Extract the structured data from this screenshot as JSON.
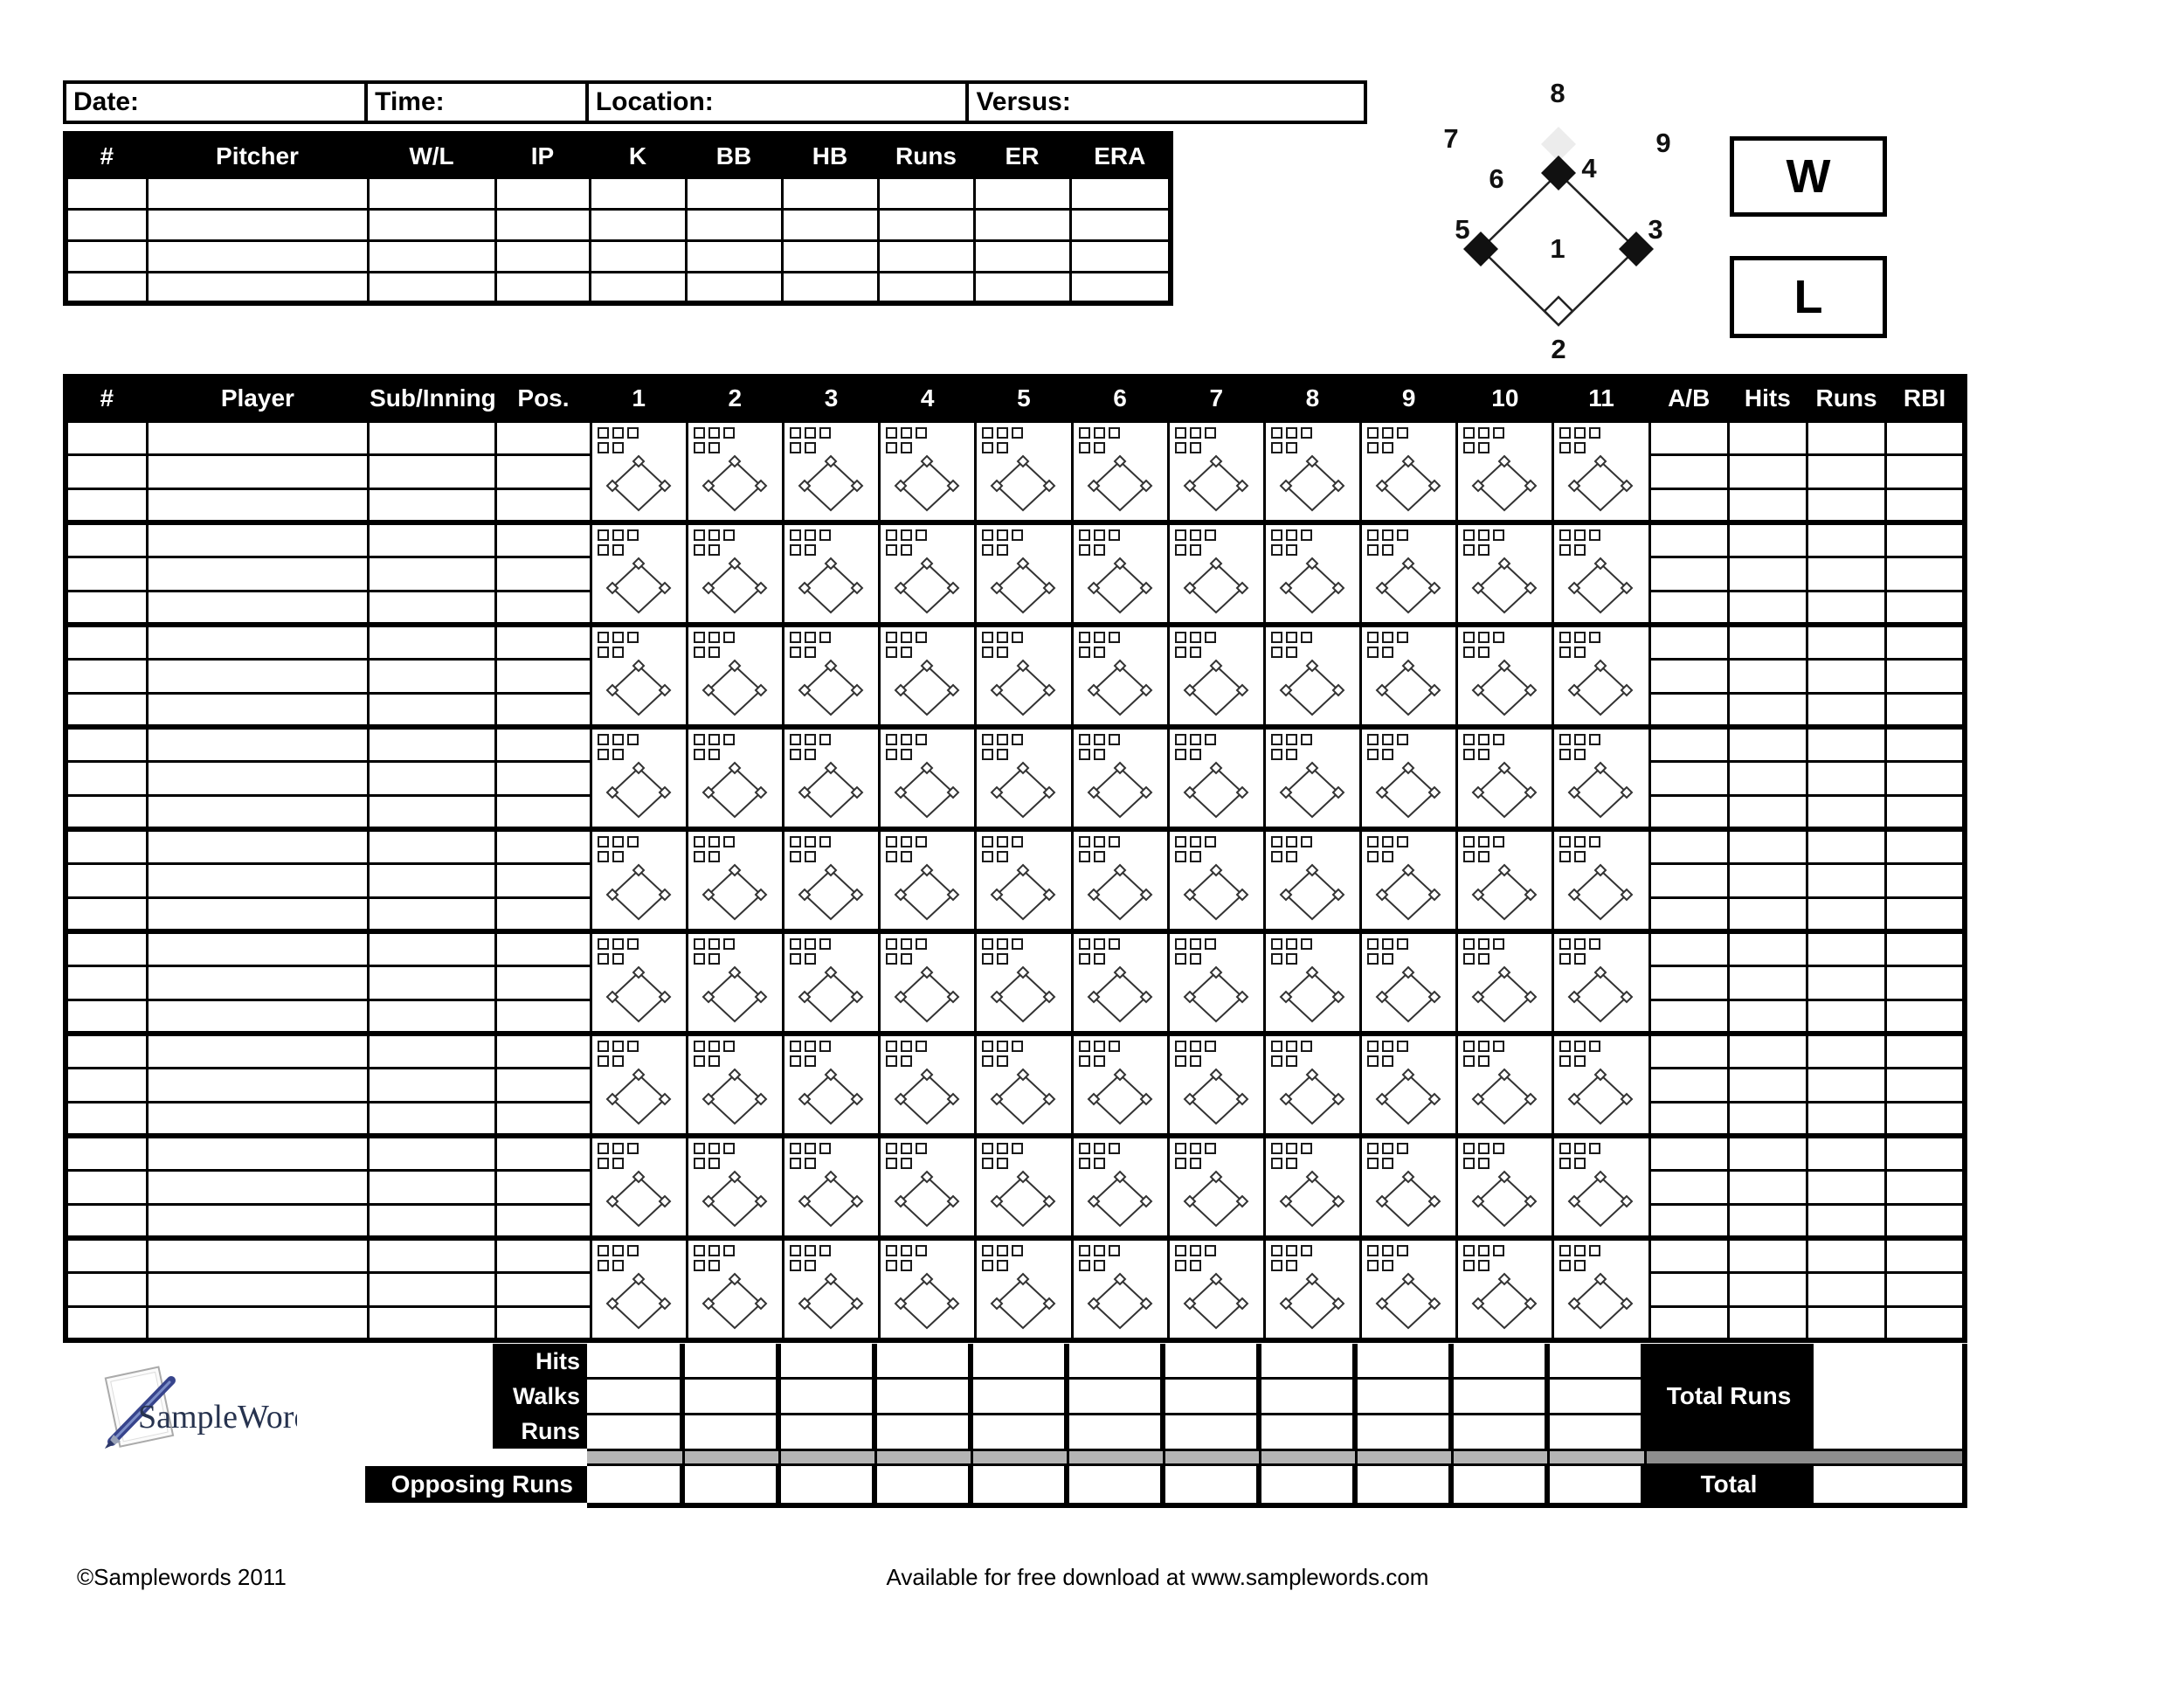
{
  "page": {
    "info_fields": [
      {
        "label": "Date:"
      },
      {
        "label": "Time:"
      },
      {
        "label": "Location:"
      },
      {
        "label": "Versus:"
      }
    ],
    "pitcher_table": {
      "headers": [
        "#",
        "Pitcher",
        "W/L",
        "IP",
        "K",
        "BB",
        "HB",
        "Runs",
        "ER",
        "ERA"
      ],
      "empty_rows": 4
    },
    "field_diagram": {
      "position_numbers": [
        "1",
        "2",
        "3",
        "4",
        "5",
        "6",
        "7",
        "8",
        "9"
      ]
    },
    "result_boxes": {
      "win": "W",
      "loss": "L"
    },
    "scorecard": {
      "left_headers": [
        "#",
        "Player",
        "Sub/Inning",
        "Pos."
      ],
      "inning_headers": [
        "1",
        "2",
        "3",
        "4",
        "5",
        "6",
        "7",
        "8",
        "9",
        "10",
        "11"
      ],
      "stat_headers": [
        "A/B",
        "Hits",
        "Runs",
        "RBI"
      ],
      "player_blocks": 9,
      "rows_per_block": 3,
      "checkboxes_per_inning": 5
    },
    "summary": {
      "row_labels": [
        "Hits",
        "Walks",
        "Runs"
      ],
      "opposing_label": "Opposing Runs",
      "total_runs_label": "Total Runs",
      "total_label": "Total"
    },
    "logo_text": "SampleWords",
    "footer": {
      "copyright": "©Samplewords 2011",
      "download_note": "Available for free download at www.samplewords.com"
    },
    "colors": {
      "header_bg": "#000000",
      "header_text": "#ffffff",
      "gray_bar_left": "#b4b4b4",
      "gray_bar_right": "#8e8e8e",
      "field_shadow": "#ececec",
      "logo_text_color": "#27334f",
      "logo_pen_color": "#4a5fa5"
    }
  }
}
